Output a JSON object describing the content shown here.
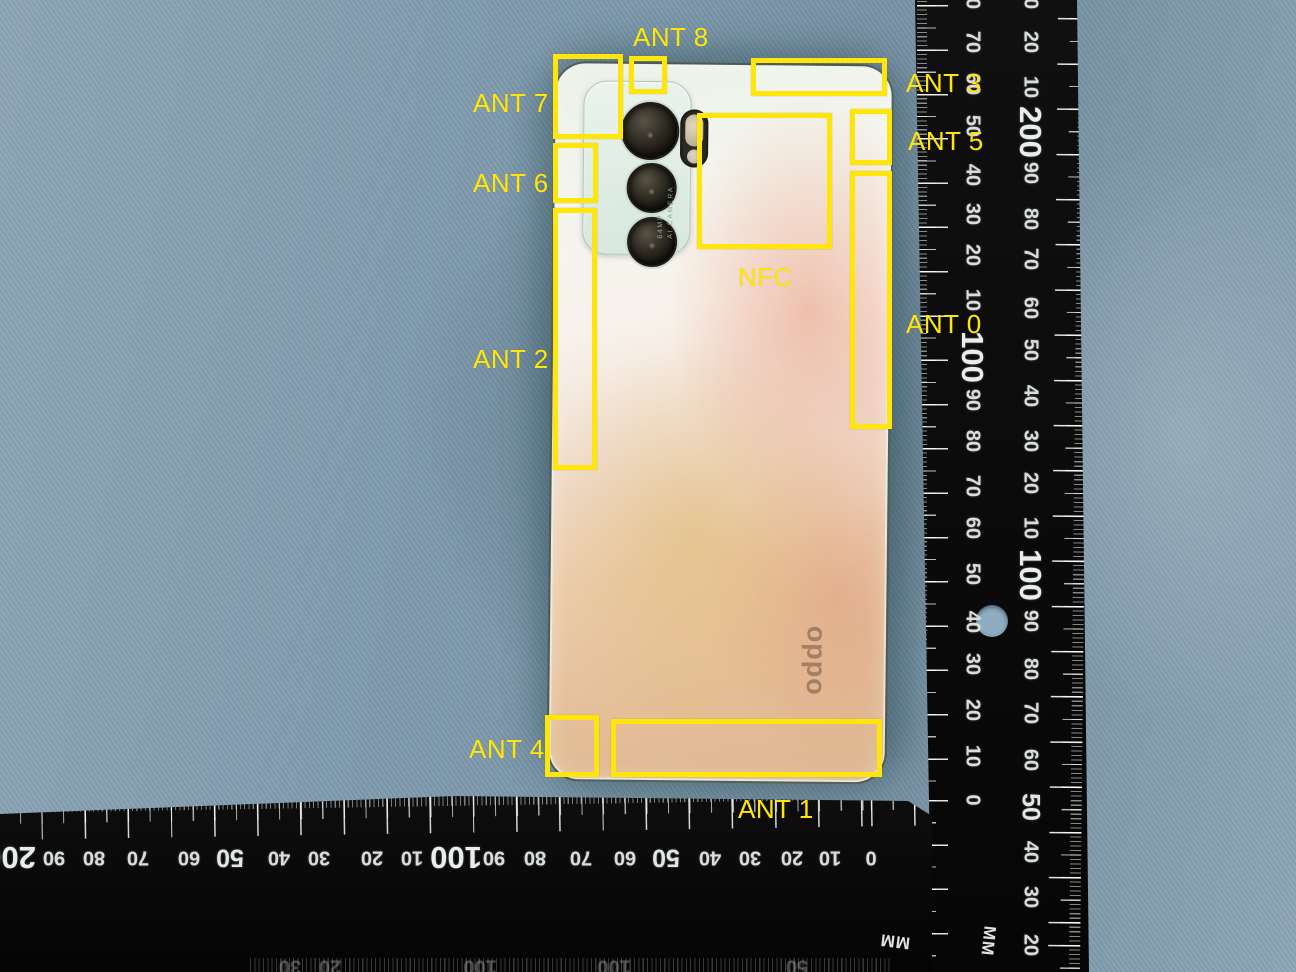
{
  "colors": {
    "annotation_yellow": "#ffe60a",
    "cloth_blue": "#7f9bae",
    "ruler_black": "#0b0b0b",
    "tick_white": "#e9eeec",
    "phone_mint": "#ecf3e8",
    "phone_gold": "#e2bd92",
    "phone_pink": "#eb9a7d"
  },
  "phone": {
    "brand_logo": "oppo",
    "camera_spec_line1": "64MP",
    "camera_spec_line2": "AI CAMERA"
  },
  "annotations": [
    {
      "id": "ant-7",
      "label": "ANT 7",
      "box": {
        "x": 553,
        "y": 54,
        "w": 70,
        "h": 85
      },
      "label_pos": {
        "x": 473,
        "y": 88
      }
    },
    {
      "id": "ant-8",
      "label": "ANT 8",
      "box": {
        "x": 629,
        "y": 56,
        "w": 38,
        "h": 38
      },
      "label_pos": {
        "x": 633,
        "y": 22
      }
    },
    {
      "id": "ant-3",
      "label": "ANT 3",
      "box": {
        "x": 751,
        "y": 58,
        "w": 136,
        "h": 38
      },
      "label_pos": {
        "x": 906,
        "y": 68
      }
    },
    {
      "id": "ant-5",
      "label": "ANT 5",
      "box": {
        "x": 850,
        "y": 109,
        "w": 42,
        "h": 56
      },
      "label_pos": {
        "x": 908,
        "y": 126
      }
    },
    {
      "id": "ant-6",
      "label": "ANT 6",
      "box": {
        "x": 553,
        "y": 143,
        "w": 45,
        "h": 60
      },
      "label_pos": {
        "x": 473,
        "y": 168
      }
    },
    {
      "id": "nfc",
      "label": "NFC",
      "box": {
        "x": 697,
        "y": 113,
        "w": 135,
        "h": 136
      },
      "label_pos": {
        "x": 738,
        "y": 262
      }
    },
    {
      "id": "ant-0",
      "label": "ANT 0",
      "box": {
        "x": 850,
        "y": 171,
        "w": 42,
        "h": 258
      },
      "label_pos": {
        "x": 906,
        "y": 309
      }
    },
    {
      "id": "ant-2",
      "label": "ANT 2",
      "box": {
        "x": 553,
        "y": 208,
        "w": 44,
        "h": 262
      },
      "label_pos": {
        "x": 473,
        "y": 344
      }
    },
    {
      "id": "ant-4",
      "label": "ANT 4",
      "box": {
        "x": 545,
        "y": 715,
        "w": 54,
        "h": 62
      },
      "label_pos": {
        "x": 469,
        "y": 734
      }
    },
    {
      "id": "ant-1",
      "label": "ANT 1",
      "box": {
        "x": 611,
        "y": 719,
        "w": 271,
        "h": 58
      },
      "label_pos": {
        "x": 738,
        "y": 794
      }
    }
  ],
  "rulers": {
    "vertical": {
      "unit": "MM",
      "inner_column_x": 972,
      "outer_column_x": 1030,
      "inner_numbers": [
        {
          "v": "80",
          "y": -2
        },
        {
          "v": "70",
          "y": 42
        },
        {
          "v": "60",
          "y": 84
        },
        {
          "v": "50",
          "y": 126
        },
        {
          "v": "40",
          "y": 175
        },
        {
          "v": "30",
          "y": 214
        },
        {
          "v": "20",
          "y": 255
        },
        {
          "v": "10",
          "y": 300
        },
        {
          "v": "100",
          "y": 357,
          "size": "big"
        },
        {
          "v": "90",
          "y": 400
        },
        {
          "v": "80",
          "y": 441
        },
        {
          "v": "70",
          "y": 486
        },
        {
          "v": "60",
          "y": 528
        },
        {
          "v": "50",
          "y": 574
        },
        {
          "v": "40",
          "y": 622
        },
        {
          "v": "30",
          "y": 664
        },
        {
          "v": "20",
          "y": 710
        },
        {
          "v": "10",
          "y": 756
        },
        {
          "v": "0",
          "y": 800
        }
      ],
      "outer_numbers": [
        {
          "v": "30",
          "y": -2
        },
        {
          "v": "20",
          "y": 42
        },
        {
          "v": "10",
          "y": 87
        },
        {
          "v": "200",
          "y": 132,
          "size": "big"
        },
        {
          "v": "90",
          "y": 173
        },
        {
          "v": "80",
          "y": 219
        },
        {
          "v": "70",
          "y": 259
        },
        {
          "v": "60",
          "y": 308
        },
        {
          "v": "50",
          "y": 350
        },
        {
          "v": "40",
          "y": 396
        },
        {
          "v": "30",
          "y": 441
        },
        {
          "v": "20",
          "y": 483
        },
        {
          "v": "10",
          "y": 528
        },
        {
          "v": "100",
          "y": 575,
          "size": "big"
        },
        {
          "v": "90",
          "y": 621
        },
        {
          "v": "80",
          "y": 669
        },
        {
          "v": "70",
          "y": 713
        },
        {
          "v": "60",
          "y": 760
        },
        {
          "v": "50",
          "y": 807,
          "size": "mid"
        },
        {
          "v": "40",
          "y": 852
        },
        {
          "v": "30",
          "y": 897
        },
        {
          "v": "20",
          "y": 945
        }
      ]
    },
    "bottom": {
      "unit": "MM",
      "row_y": 857,
      "numbers": [
        {
          "v": "200",
          "x": 10,
          "size": "big"
        },
        {
          "v": "90",
          "x": 54
        },
        {
          "v": "80",
          "x": 94
        },
        {
          "v": "70",
          "x": 138
        },
        {
          "v": "60",
          "x": 189
        },
        {
          "v": "50",
          "x": 230,
          "size": "mid"
        },
        {
          "v": "40",
          "x": 279
        },
        {
          "v": "30",
          "x": 319
        },
        {
          "v": "20",
          "x": 372
        },
        {
          "v": "10",
          "x": 412
        },
        {
          "v": "100",
          "x": 456,
          "size": "big"
        },
        {
          "v": "90",
          "x": 494
        },
        {
          "v": "80",
          "x": 535
        },
        {
          "v": "70",
          "x": 581
        },
        {
          "v": "60",
          "x": 625
        },
        {
          "v": "50",
          "x": 666,
          "size": "mid"
        },
        {
          "v": "40",
          "x": 710
        },
        {
          "v": "30",
          "x": 750
        },
        {
          "v": "20",
          "x": 792
        },
        {
          "v": "10",
          "x": 830
        },
        {
          "v": "0",
          "x": 871
        }
      ],
      "faint_row_y": 966,
      "faint_numbers": [
        {
          "v": "30",
          "x": 290
        },
        {
          "v": "20",
          "x": 330
        },
        {
          "v": "100",
          "x": 480
        },
        {
          "v": "100",
          "x": 614
        },
        {
          "v": "50",
          "x": 797
        }
      ]
    }
  }
}
